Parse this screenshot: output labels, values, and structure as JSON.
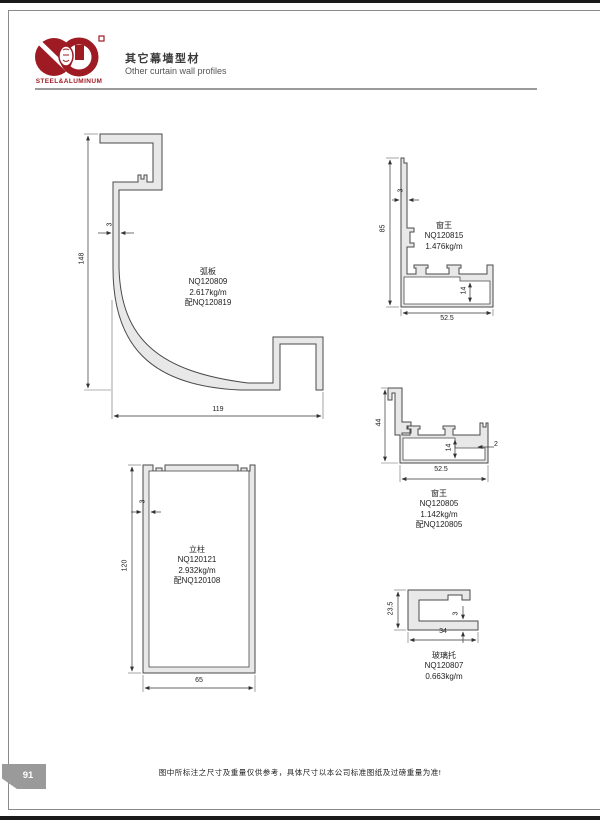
{
  "header": {
    "logo_text": "STEEL&ALUMINUM",
    "title_cn": "其它幕墙型材",
    "title_en": "Other curtain wall profiles"
  },
  "profiles": {
    "arc": {
      "name": "弧板",
      "code": "NQ120809",
      "weight": "2.617kg/m",
      "match": "配NQ120819",
      "dim_height": "148",
      "dim_thickness": "3",
      "dim_width": "119"
    },
    "win_top": {
      "name": "窗王",
      "code": "NQ120815",
      "weight": "1.476kg/m",
      "dim_height": "85",
      "dim_thickness": "3",
      "dim_inner": "14",
      "dim_width": "52.5"
    },
    "win_mid": {
      "name": "窗王",
      "code": "NQ120805",
      "weight": "1.142kg/m",
      "match": "配NQ120805",
      "dim_height": "44",
      "dim_inner": "14",
      "dim_width": "52.5",
      "dim_thickness": "2"
    },
    "mullion": {
      "name": "立柱",
      "code": "NQ120121",
      "weight": "2.932kg/m",
      "match": "配NQ120108",
      "dim_height": "120",
      "dim_thickness": "3",
      "dim_width": "65"
    },
    "glass": {
      "name": "玻璃托",
      "code": "NQ120807",
      "weight": "0.663kg/m",
      "dim_height": "23.5",
      "dim_width": "34",
      "dim_thickness": "3"
    }
  },
  "footer": {
    "page_number": "91",
    "note": "图中所标注之尺寸及重量仅供参考，具体尺寸以本公司标准图纸及过磅重量为准!"
  },
  "colors": {
    "brand_red": "#9e1b23",
    "profile_fill": "#e8e8e8",
    "line_gray": "#8a8a8a"
  }
}
